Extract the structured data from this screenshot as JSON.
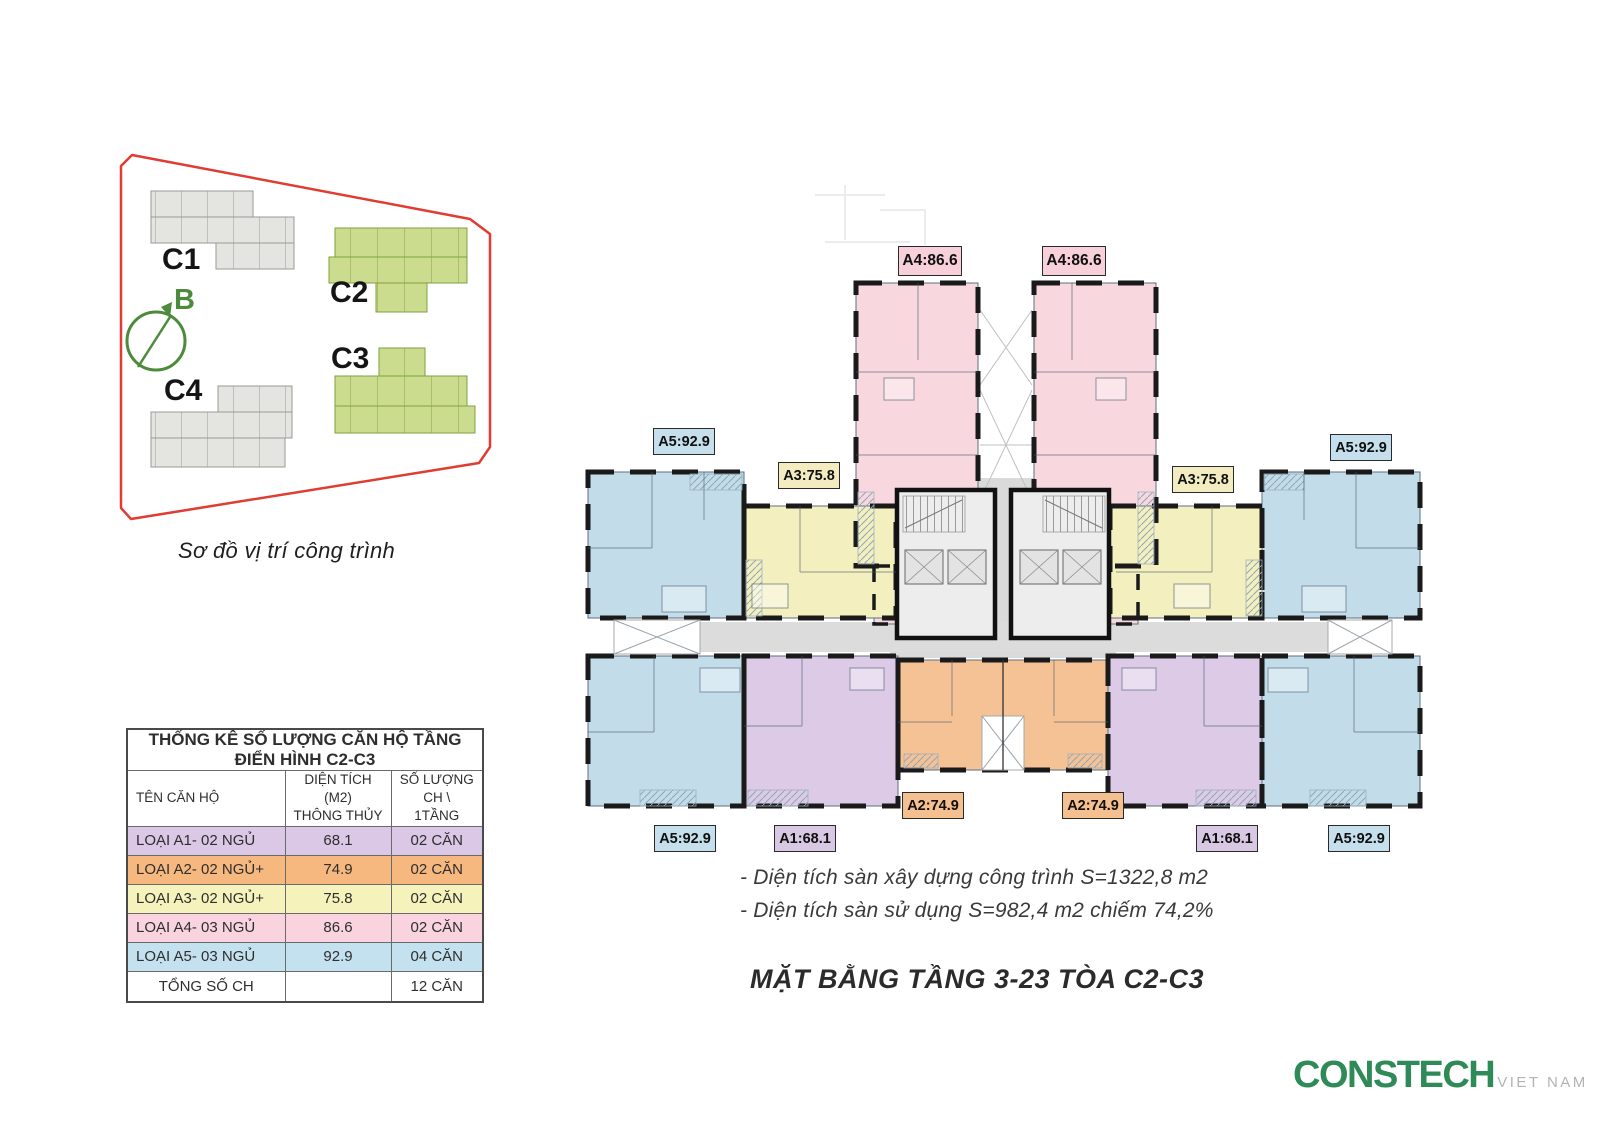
{
  "site_diagram": {
    "caption": "Sơ đồ vị trí công trình",
    "buildings": {
      "c1": "C1",
      "c2": "C2",
      "c3": "C3",
      "c4": "C4"
    },
    "compass_label": "B",
    "boundary_color": "#e03c31",
    "highlight_building_color": "#cbdc8f",
    "muted_building_color": "#e4e4e1",
    "compass_color": "#4b8b3b"
  },
  "stats_table": {
    "title": "THỐNG KÊ SỐ LƯỢNG CĂN HỘ TẦNG ĐIỂN HÌNH C2-C3",
    "columns": [
      "TÊN CĂN HỘ",
      "DIỆN TÍCH (M2)\nTHÔNG THỦY",
      "SỐ LƯỢNG\nCH \\ 1TẦNG"
    ],
    "rows": [
      {
        "name": "LOẠI A1- 02 NGỦ",
        "area": "68.1",
        "count": "02 CĂN",
        "color": "#dbc7e6"
      },
      {
        "name": "LOẠI A2- 02 NGỦ+",
        "area": "74.9",
        "count": "02 CĂN",
        "color": "#f6b87e"
      },
      {
        "name": "LOẠI A3- 02 NGỦ+",
        "area": "75.8",
        "count": "02 CĂN",
        "color": "#f6f2bb"
      },
      {
        "name": "LOẠI A4- 03 NGỦ",
        "area": "86.6",
        "count": "02 CĂN",
        "color": "#f9d4de"
      },
      {
        "name": "LOẠI A5- 03 NGỦ",
        "area": "92.9",
        "count": "04 CĂN",
        "color": "#c4e1ef"
      },
      {
        "name": "TỔNG SỐ CH",
        "area": "",
        "count": "12 CĂN",
        "color": "#ffffff"
      }
    ]
  },
  "floor_plan": {
    "caption": "MẶT BẰNG TẦNG 3-23 TÒA C2-C3",
    "notes": [
      "- Diện tích sàn xây dựng công trình S=1322,8 m2",
      "- Diện tích sàn sử dụng S=982,4 m2 chiếm 74,2%"
    ],
    "unit_colors": {
      "a1": "#dccae6",
      "a2": "#f4c295",
      "a3": "#f4efbe",
      "a4": "#f8d8de",
      "a5": "#c2dcea"
    },
    "labels": [
      {
        "id": "a4-left",
        "text": "A4:86.6",
        "color": "#f8d0da"
      },
      {
        "id": "a4-right",
        "text": "A4:86.6",
        "color": "#f8d0da"
      },
      {
        "id": "a5-top-left",
        "text": "A5:92.9",
        "color": "#c5dfec"
      },
      {
        "id": "a5-top-right",
        "text": "A5:92.9",
        "color": "#c5dfec"
      },
      {
        "id": "a3-left",
        "text": "A3:75.8",
        "color": "#f2ecc0"
      },
      {
        "id": "a3-right",
        "text": "A3:75.8",
        "color": "#f2ecc0"
      },
      {
        "id": "a2-left",
        "text": "A2:74.9",
        "color": "#f5c08f"
      },
      {
        "id": "a2-right",
        "text": "A2:74.9",
        "color": "#f5c08f"
      },
      {
        "id": "a1-left",
        "text": "A1:68.1",
        "color": "#d9c8e3"
      },
      {
        "id": "a1-right",
        "text": "A1:68.1",
        "color": "#d9c8e3"
      },
      {
        "id": "a5-bottom-left",
        "text": "A5:92.9",
        "color": "#c5dfec"
      },
      {
        "id": "a5-bottom-right",
        "text": "A5:92.9",
        "color": "#c5dfec"
      }
    ]
  },
  "logo": {
    "brand": "CONSTECH",
    "region": "VIET NAM",
    "brand_color": "#2e8b57"
  }
}
